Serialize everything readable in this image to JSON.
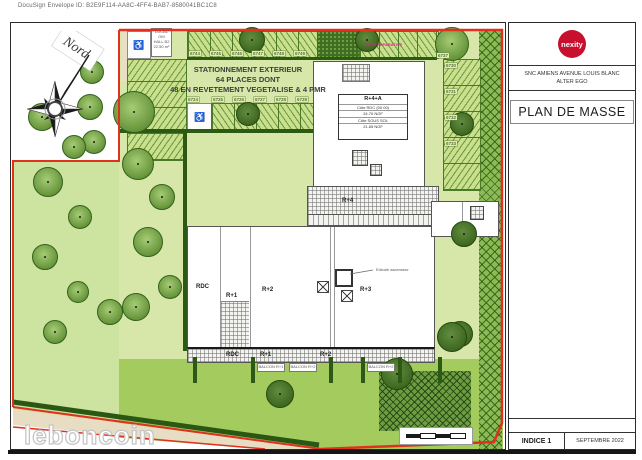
{
  "meta": {
    "docusign": "DocuSign Envelope ID: B2E9F114-AA8C-4FF4-BAB7-8580041BC1C8"
  },
  "compass": {
    "label": "Nord"
  },
  "parking_note": {
    "line1": "STATIONNEMENT EXTERIEUR",
    "line2": "64 PLACES DONT",
    "line3": "48 EN REVETEMENT VEGETALISE & 4 PMR"
  },
  "buildings": {
    "r4a": {
      "title": "R+4+A",
      "row1": "Côte RDC (00.00)",
      "row2": "24.70 NGF",
      "row3": "Côte SOUS SOL",
      "row4": "21.65 NGF"
    },
    "roof_label": "R+4",
    "floor_labels": {
      "rdc": "RDC",
      "r1": "R+1",
      "r2": "R+2",
      "r3": "R+3"
    },
    "strip_labels": {
      "rdc": "RDC",
      "r1": "R+1",
      "r2": "R+2"
    },
    "balconies": [
      "BALCON R+1",
      "BALCON R+2",
      "BALCON R+2"
    ],
    "elevator_note": "Edicule ascenseur"
  },
  "local_box": {
    "l1": "LOCAL OM",
    "l2": "HALL B2",
    "l3": "22.50 m²"
  },
  "notes": {
    "pink": "LIMITE SEPARATIVE"
  },
  "parking": {
    "pmr_icon": "♿",
    "top_row": [
      "6744",
      "6745",
      "6746",
      "6747",
      "6748",
      "6749"
    ],
    "top_right": "6737",
    "mid_row": [
      "6724",
      "6725",
      "6726",
      "6727",
      "6728",
      "6729"
    ],
    "right_col": [
      "6730",
      "6731",
      "6732",
      "6733"
    ]
  },
  "titleblock": {
    "logo": "nexity",
    "project_line1": "SNC AMIENS AVENUE LOUIS BLANC",
    "project_line2": "ALTER EGO",
    "doc_title": "PLAN DE MASSE",
    "indice": "INDICE 1",
    "date": "SEPTEMBRE 2022"
  },
  "watermark": "leboncoin",
  "colors": {
    "nexity_red": "#c8102e",
    "boundary_red": "#e0301e",
    "site_green": "#d7e7a9",
    "lawn_green": "#a4cb5d",
    "hedge_green": "#2c5a15"
  }
}
